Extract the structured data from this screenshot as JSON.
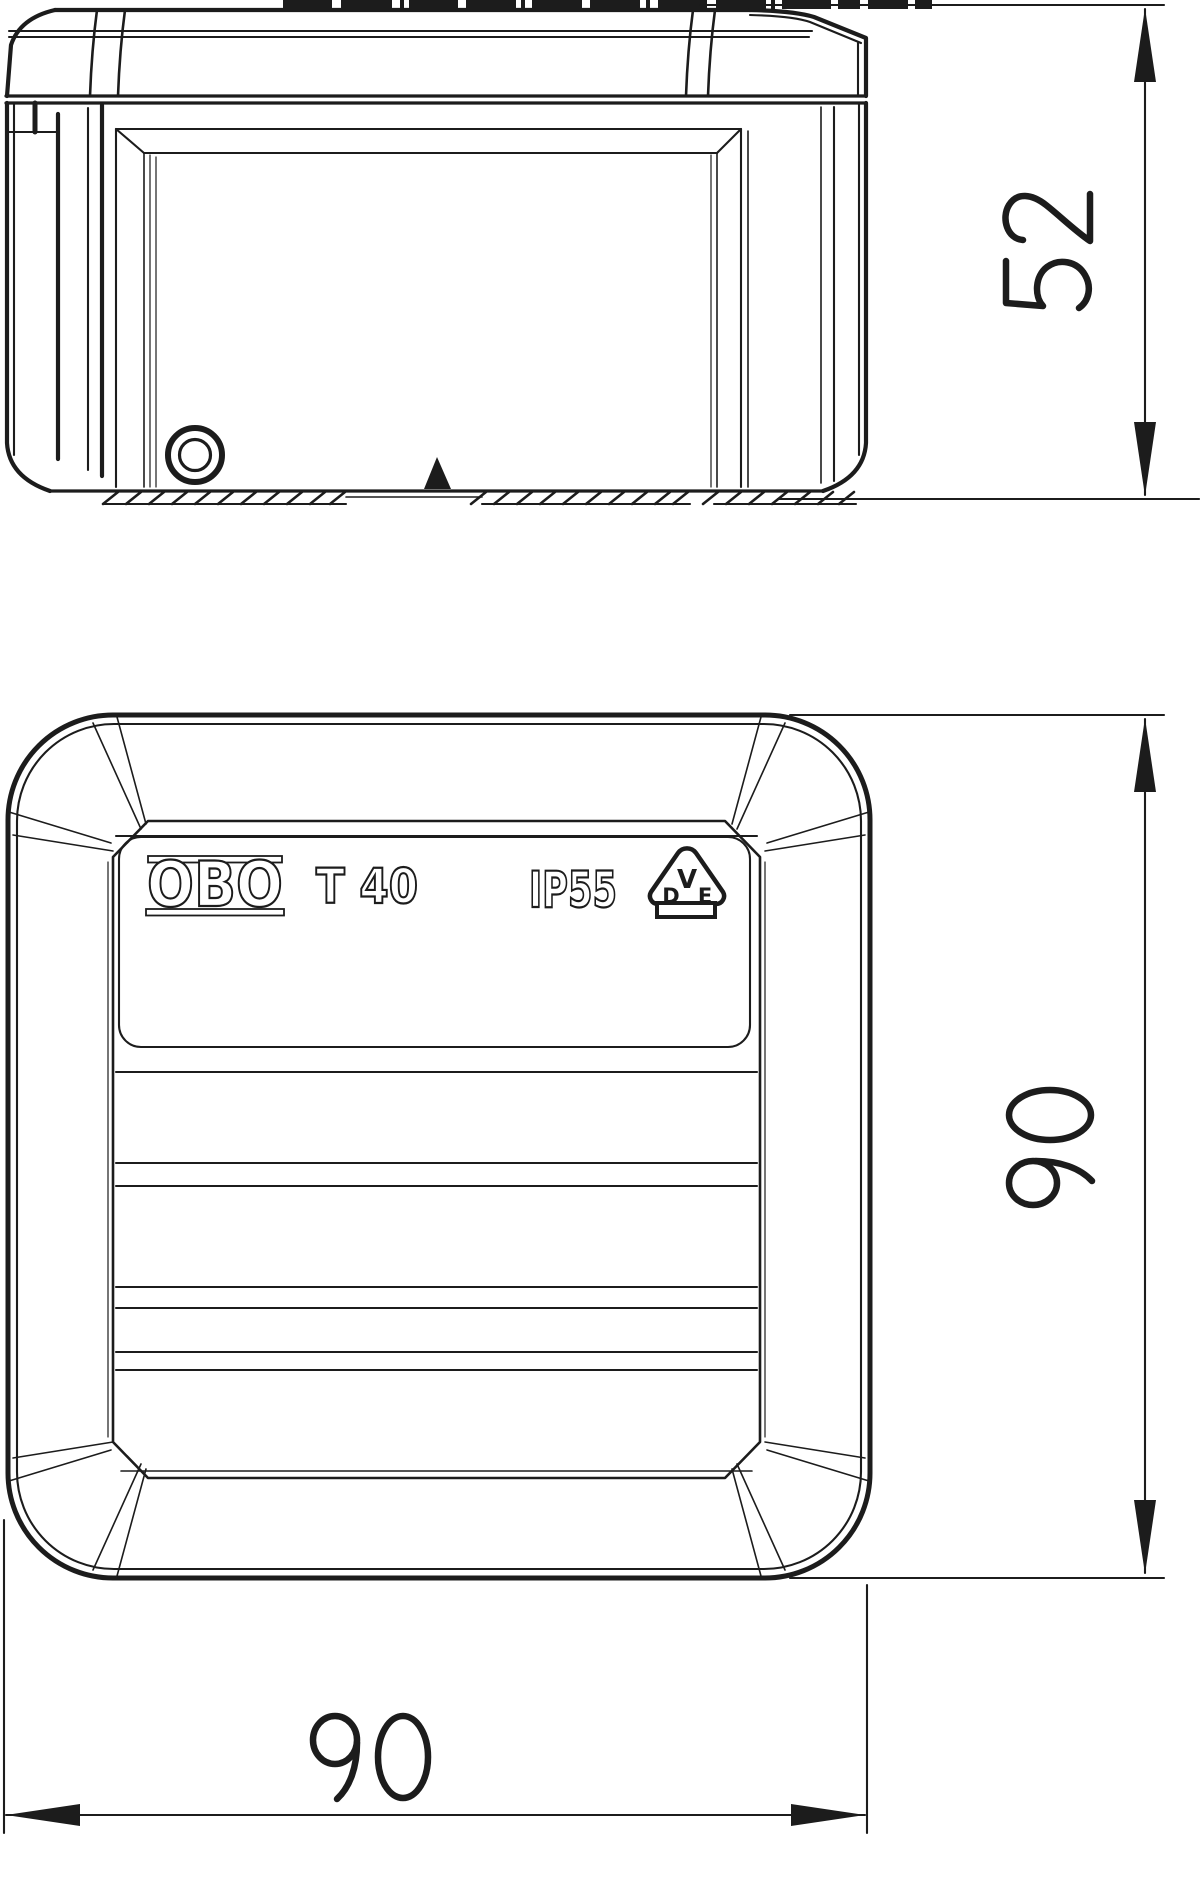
{
  "product_label": {
    "brand": "OBO",
    "model": "T 40",
    "ip_rating": "IP55",
    "vde_mark": {
      "top": "V",
      "bottom_left": "D",
      "bottom_right": "E"
    }
  },
  "dimensions": {
    "side_height_mm": "52",
    "plan_height_mm": "90",
    "plan_width_mm": "90"
  },
  "icons": {
    "screw_head": "concentric-circles",
    "position_marker": "filled-triangle-up",
    "vde_certification": "vde-triangle-mark",
    "mounting_surface": "hatch-dashes"
  },
  "colors": {
    "line": "#1c1c1c",
    "background": "#ffffff"
  }
}
